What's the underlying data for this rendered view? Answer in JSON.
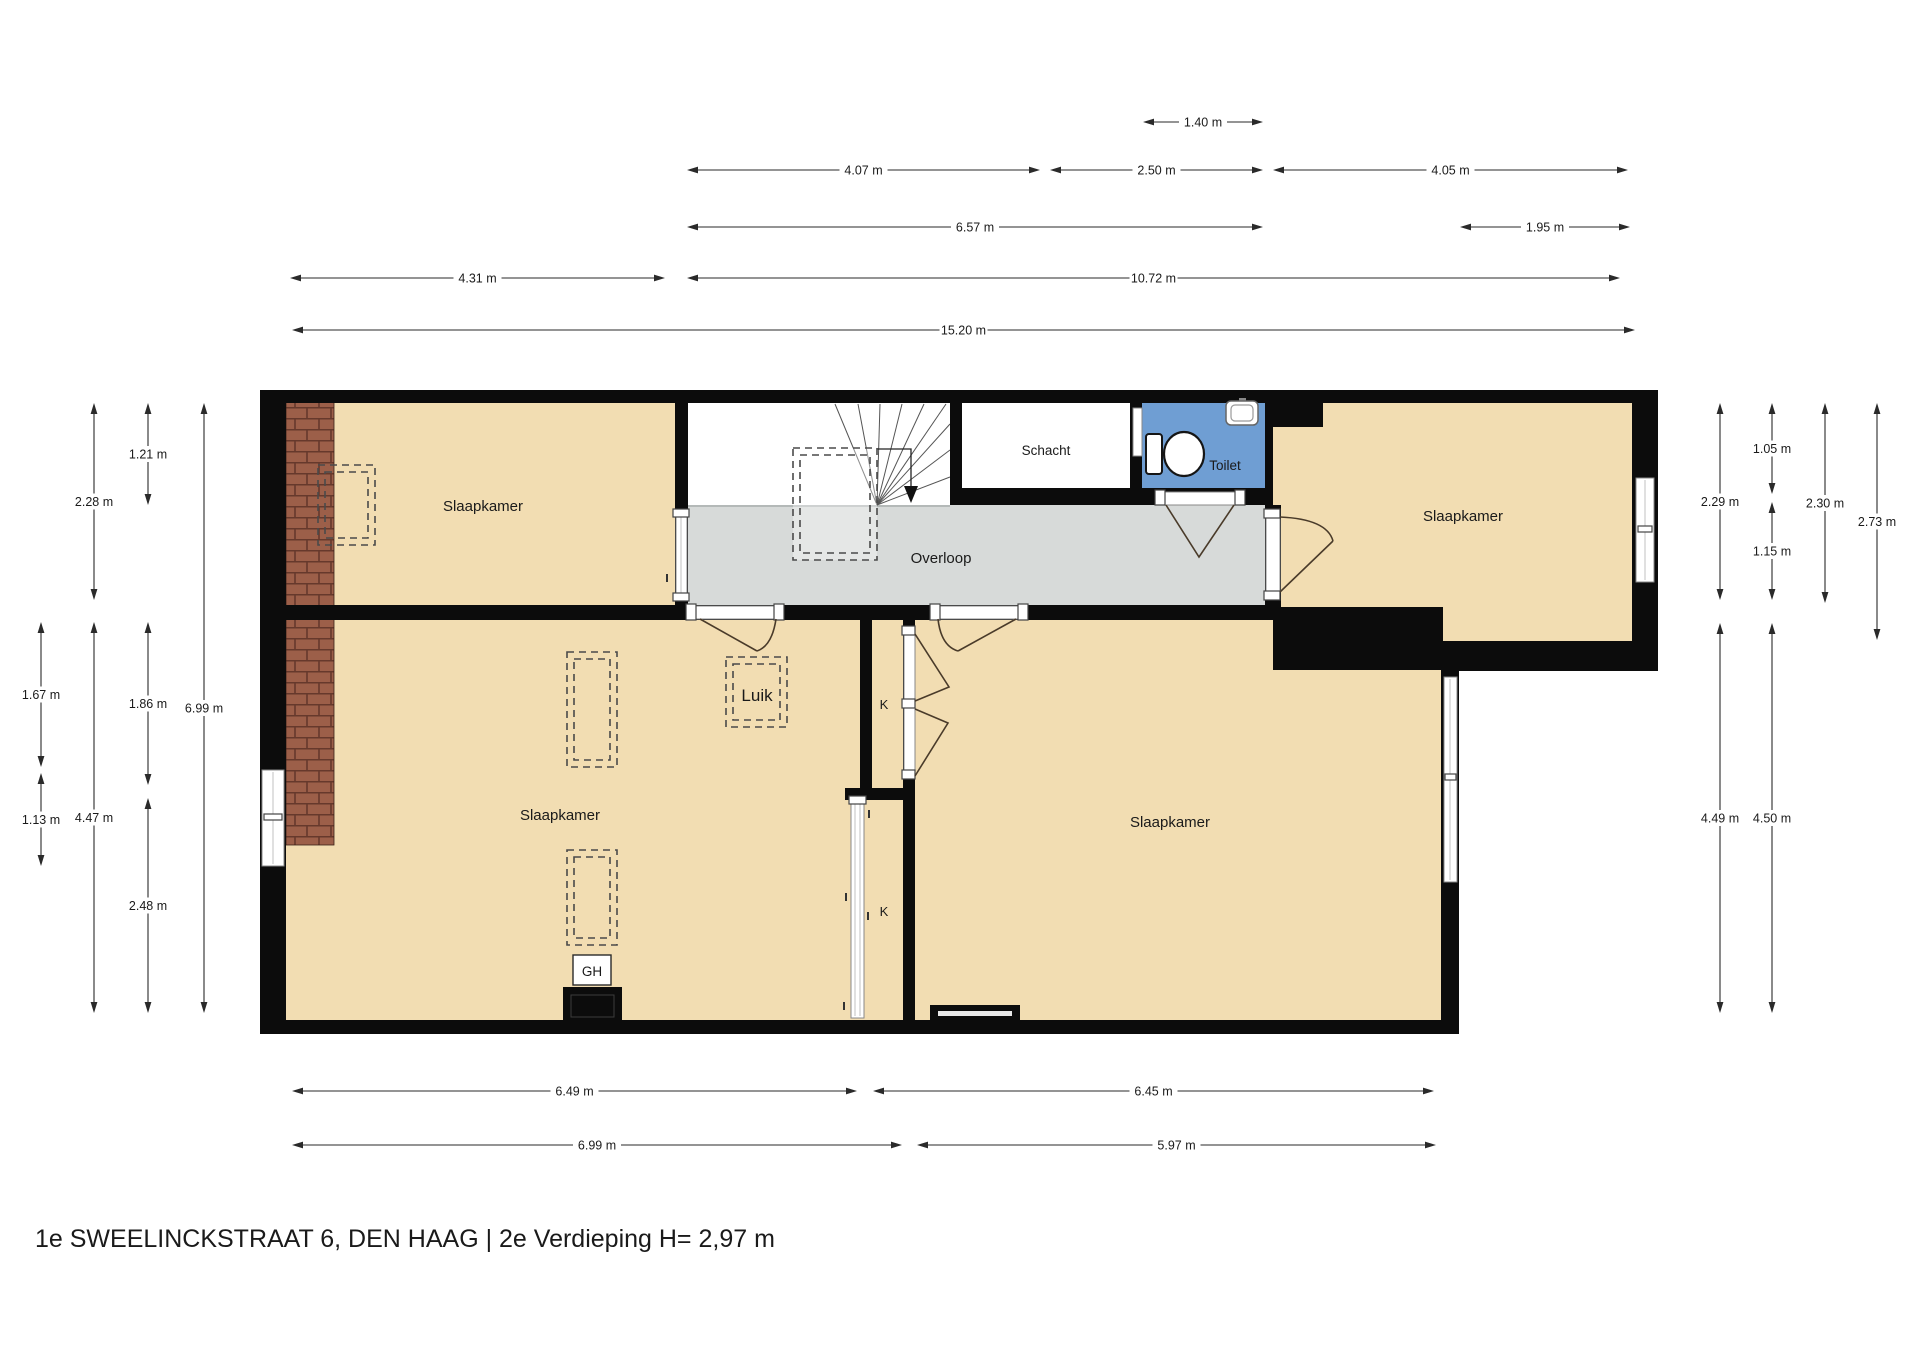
{
  "title": "1e SWEELINCKSTRAAT 6, DEN HAAG | 2e Verdieping H= 2,97 m",
  "rooms": {
    "bedroom_top_left": "Slaapkamer",
    "bedroom_top_right": "Slaapkamer",
    "bedroom_bottom_left": "Slaapkamer",
    "bedroom_bottom_right": "Slaapkamer",
    "landing": "Overloop",
    "shaft": "Schacht",
    "toilet": "Toilet",
    "hatch": "Luik",
    "closet_top": "K",
    "closet_bottom": "K",
    "geyser": "GH"
  },
  "dimensions": {
    "top": [
      "1.40 m",
      "4.07 m",
      "2.50 m",
      "4.05 m",
      "6.57 m",
      "1.95 m",
      "4.31 m",
      "10.72 m",
      "15.20 m"
    ],
    "left": [
      "1.21 m",
      "2.28 m",
      "1.67 m",
      "1.13 m",
      "1.86 m",
      "2.48 m",
      "4.47 m",
      "6.99 m"
    ],
    "right": [
      "1.05 m",
      "2.29 m",
      "2.30 m",
      "2.73 m",
      "1.15 m",
      "4.49 m",
      "4.50 m"
    ],
    "bottom": [
      "6.49 m",
      "6.45 m",
      "6.99 m",
      "5.97 m"
    ]
  },
  "colors": {
    "floor": "#f2ddb2",
    "landing": "#d7dad9",
    "toilet": "#6f9ed3",
    "wall": "#0c0c0c",
    "brick": "#9c5f49",
    "brick_mortar": "#66392c",
    "dimension": "#2a2a2a",
    "door": "#4a3b2a"
  }
}
